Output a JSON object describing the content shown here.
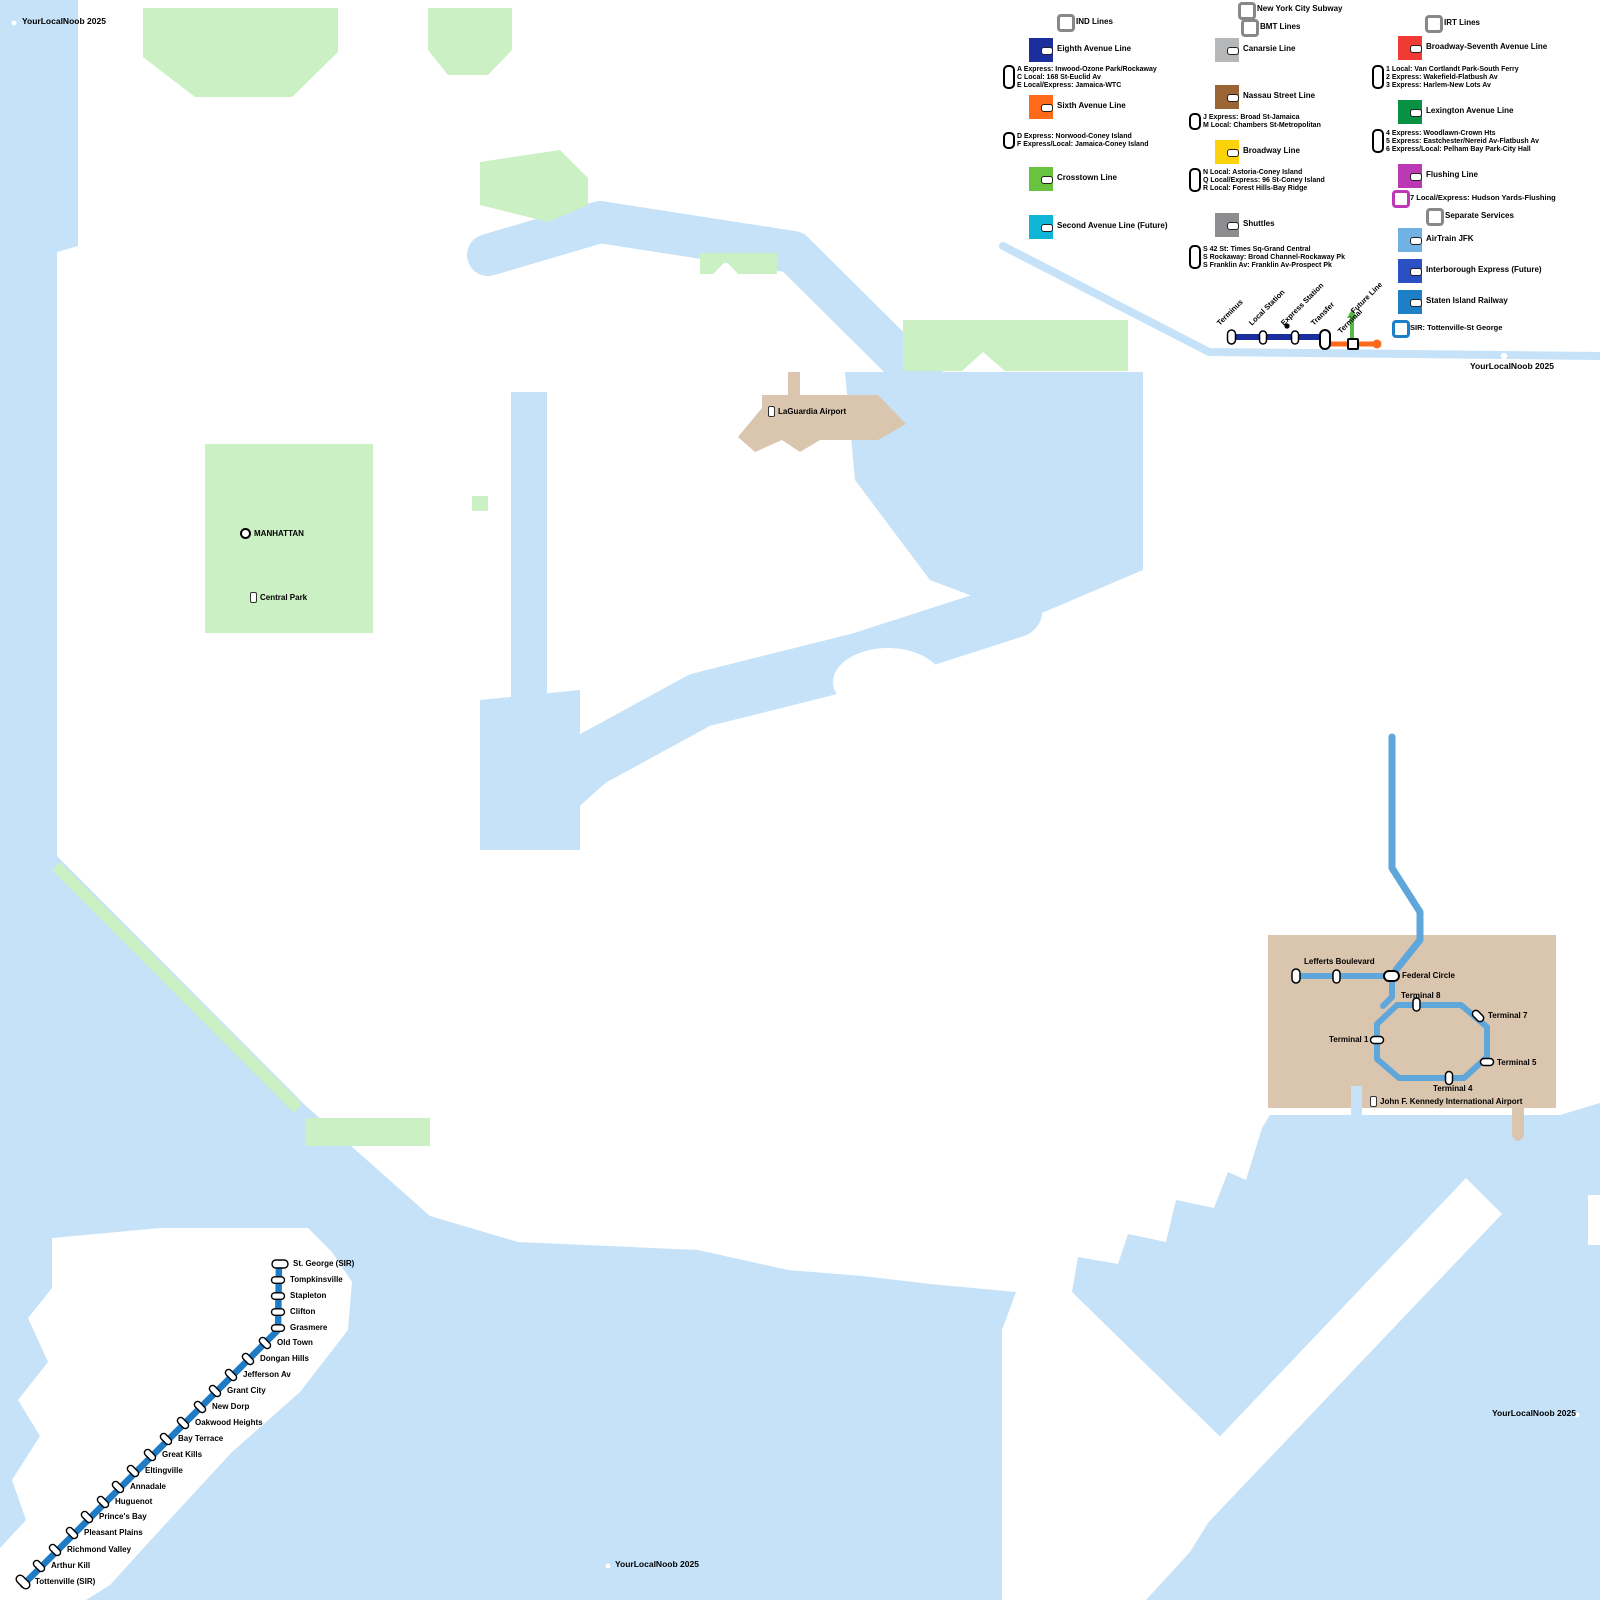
{
  "title": "New York City Subway",
  "watermarks": {
    "top_left": "YourLocalNoob 2025",
    "legend_area": "YourLocalNoob 2025",
    "bottom_center": "YourLocalNoob 2025",
    "bottom_right": "YourLocalNoob 2025"
  },
  "colors": {
    "water": "#C5E2F8",
    "land": "#FFFFFF",
    "park": "#CBF0C3",
    "airport_ground": "#DAC5AE",
    "sir_line": "#1F7CC4",
    "airtrain_line": "#5FA7DB",
    "future_line_green": "#58B844",
    "key_blue": "#1B2E9E",
    "key_orange": "#FF6A1A",
    "header_ring": "#888888"
  },
  "legend": {
    "ind": {
      "header": "IND Lines",
      "items": [
        {
          "label": "Eighth Avenue Line",
          "color": "#1B2E9E",
          "services": [
            "A Express: Inwood-Ozone Park/Rockaway",
            "C Local: 168 St-Euclid Av",
            "E Local/Express: Jamaica-WTC"
          ]
        },
        {
          "label": "Sixth Avenue Line",
          "color": "#FF6A1A",
          "services": [
            "D Express: Norwood-Coney Island",
            "F Express/Local: Jamaica-Coney Island"
          ]
        },
        {
          "label": "Crosstown Line",
          "color": "#68C43E",
          "services": []
        },
        {
          "label": "Second Avenue Line (Future)",
          "color": "#10B6D6",
          "services": []
        }
      ]
    },
    "bmt": {
      "header": "BMT Lines",
      "items": [
        {
          "label": "Canarsie Line",
          "color": "#B5B7B9",
          "services": []
        },
        {
          "label": "Nassau Street Line",
          "color": "#9A6434",
          "services": [
            "J Express: Broad St-Jamaica",
            "M Local: Chambers St-Metropolitan"
          ]
        },
        {
          "label": "Broadway Line",
          "color": "#FCD20A",
          "services": [
            "N Local: Astoria-Coney Island",
            "Q Local/Express: 96 St-Coney Island",
            "R Local: Forest Hills-Bay Ridge"
          ]
        },
        {
          "label": "Shuttles",
          "color": "#8D8D8F",
          "services": [
            "S 42 St: Times Sq-Grand Central",
            "S Rockaway: Broad Channel-Rockaway Pk",
            "S Franklin Av: Franklin Av-Prospect Pk"
          ]
        }
      ]
    },
    "irt": {
      "header": "IRT Lines",
      "items": [
        {
          "label": "Broadway-Seventh Avenue Line",
          "color": "#EF3B33",
          "services": [
            "1 Local: Van Cortlandt Park-South Ferry",
            "2 Express: Wakefield-Flatbush Av",
            "3 Express: Harlem-New Lots Av"
          ]
        },
        {
          "label": "Lexington Avenue Line",
          "color": "#079143",
          "services": [
            "4 Express: Woodlawn-Crown Hts",
            "5 Express: Eastchester/Nereid Av-Flatbush Av",
            "6 Express/Local: Pelham Bay Park-City Hall"
          ]
        },
        {
          "label": "Flushing Line",
          "color": "#BB39B5",
          "services": []
        }
      ],
      "ring_item": {
        "label": "7 Local/Express: Hudson Yards-Flushing",
        "color": "#BB39B5"
      }
    },
    "separate": {
      "header": "Separate Services",
      "items": [
        {
          "label": "AirTrain JFK",
          "color": "#6FB2E3",
          "services": []
        },
        {
          "label": "Interborough Express (Future)",
          "color": "#2B50C4",
          "services": []
        },
        {
          "label": "Staten Island Railway",
          "color": "#1C7FC8",
          "services": []
        }
      ],
      "ring_item": {
        "label": "SIR: Tottenville-St George",
        "color": "#1C7FC8"
      }
    },
    "key": {
      "terminus": "Terminus",
      "local": "Local Station",
      "express": "Express Station",
      "transfer": "Transfer",
      "terminal": "Terminal",
      "future": "Future Line"
    }
  },
  "map": {
    "labels": {
      "manhattan": "MANHATTAN",
      "central_park": "Central Park",
      "laguardia": "LaGuardia Airport",
      "jfk_airport": "John F. Kennedy International Airport"
    },
    "sir": {
      "name": "Staten Island Railway",
      "stations": [
        "St. George (SIR)",
        "Tompkinsville",
        "Stapleton",
        "Clifton",
        "Grasmere",
        "Old Town",
        "Dongan Hills",
        "Jefferson Av",
        "Grant City",
        "New Dorp",
        "Oakwood Heights",
        "Bay Terrace",
        "Great Kills",
        "Eltingville",
        "Annadale",
        "Huguenot",
        "Prince's Bay",
        "Pleasant Plains",
        "Richmond Valley",
        "Arthur Kill",
        "Tottenville (SIR)"
      ]
    },
    "airtrain": {
      "name": "AirTrain JFK",
      "stations": [
        "Lefferts Boulevard",
        "Federal Circle",
        "Terminal 8",
        "Terminal 7",
        "Terminal 1",
        "Terminal 5",
        "Terminal 4"
      ]
    }
  }
}
